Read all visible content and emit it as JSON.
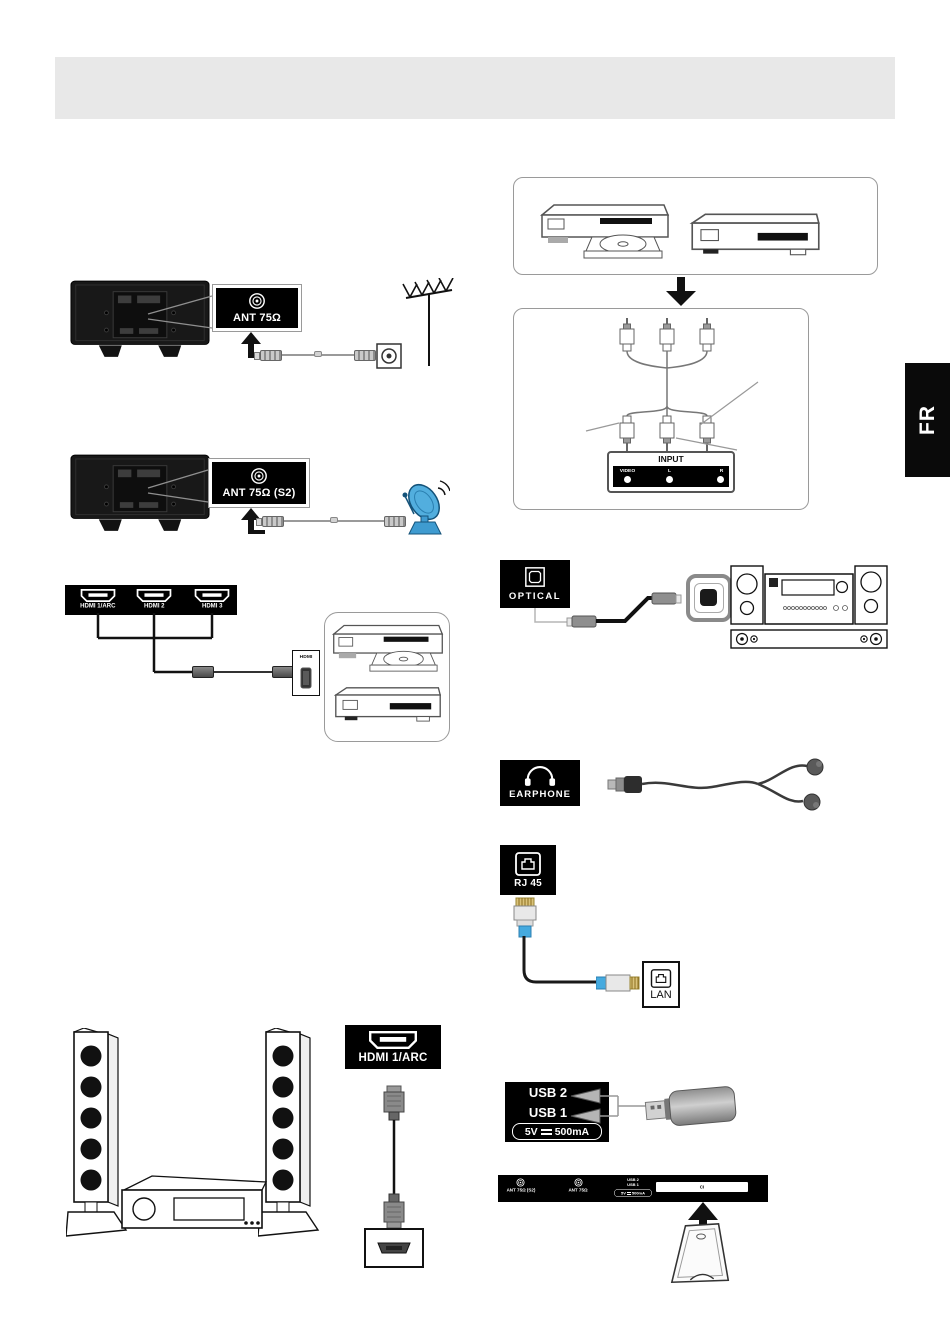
{
  "page": {
    "language_tab": "FR"
  },
  "antenna_section": {
    "port_label": "ANT 75Ω"
  },
  "satellite_section": {
    "port_label": "ANT 75Ω (S2)"
  },
  "hdmi_inputs_section": {
    "port_labels": [
      "HDMI 1/ARC",
      "HDMI 2",
      "HDMI 3"
    ],
    "device_port_label": "HDMI"
  },
  "av_input_section": {
    "panel_title": "INPUT",
    "jack_labels": [
      "VIDEO",
      "L",
      "R"
    ]
  },
  "optical_section": {
    "port_label": "OPTICAL"
  },
  "earphone_section": {
    "port_label": "EARPHONE"
  },
  "network_section": {
    "tv_port_label": "RJ 45",
    "device_port_label": "LAN"
  },
  "usb_section": {
    "port_labels": [
      "USB 2",
      "USB 1"
    ],
    "power_voltage": "5V",
    "power_current": "500mA"
  },
  "arc_section": {
    "port_label": "HDMI 1/ARC"
  },
  "ci_section": {
    "ant_s2_label": "ANT 75Ω (S2)",
    "ant_label": "ANT 75Ω",
    "usb2_label": "USB 2",
    "usb1_label": "USB 1",
    "power_voltage": "5V",
    "power_current": "500mA",
    "ci_slot_label": "CI"
  },
  "colors": {
    "label_background": "#000000",
    "header_bar": "#e8e8e8",
    "ethernet_boot_blue": "#45aadf",
    "satellite_dish_blue": "#52aede"
  }
}
